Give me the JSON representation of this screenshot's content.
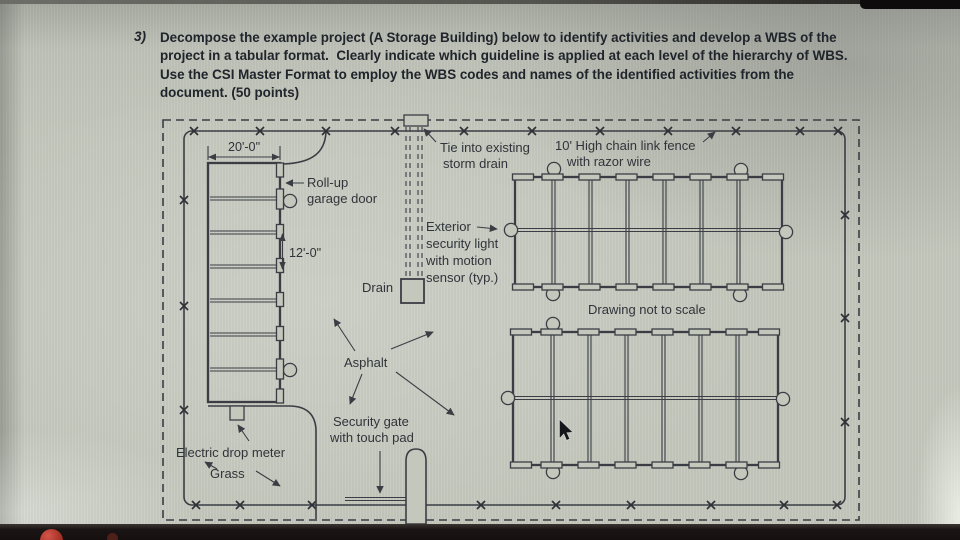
{
  "question": {
    "number": "3)",
    "lines": [
      "Decompose the example project (A Storage Building) below to identify activities and develop a WBS of the",
      "project in a tabular format.  Clearly indicate which guideline is applied at each level of the hierarchy of WBS.",
      "Use the CSI Master Format to employ the WBS codes and names of the identified activities from the",
      "document. (50 points)"
    ]
  },
  "plan": {
    "dim_width": "20'-0\"",
    "dim_bay": "12'-0\"",
    "rollup_line1": "Roll-up",
    "rollup_line2": "garage door",
    "tie_line1": "Tie into existing",
    "tie_line2": "storm drain",
    "fence_line1": "10' High chain link fence",
    "fence_line2": "with razor wire",
    "light_line1": "Exterior",
    "light_line2": "security light",
    "light_line3": "with motion",
    "light_line4": "sensor (typ.)",
    "drain": "Drain",
    "scale_note": "Drawing not to scale",
    "asphalt": "Asphalt",
    "gate_line1": "Security gate",
    "gate_line2": "with touch pad",
    "meter": "Electric drop meter",
    "grass": "Grass"
  },
  "colors": {
    "ink": "#3a3e44",
    "label_text": "#30343a",
    "question_text": "#20242b",
    "page_background": "#c3c7bc",
    "bezel": "#150f10",
    "record_dot": "#b4372b"
  }
}
